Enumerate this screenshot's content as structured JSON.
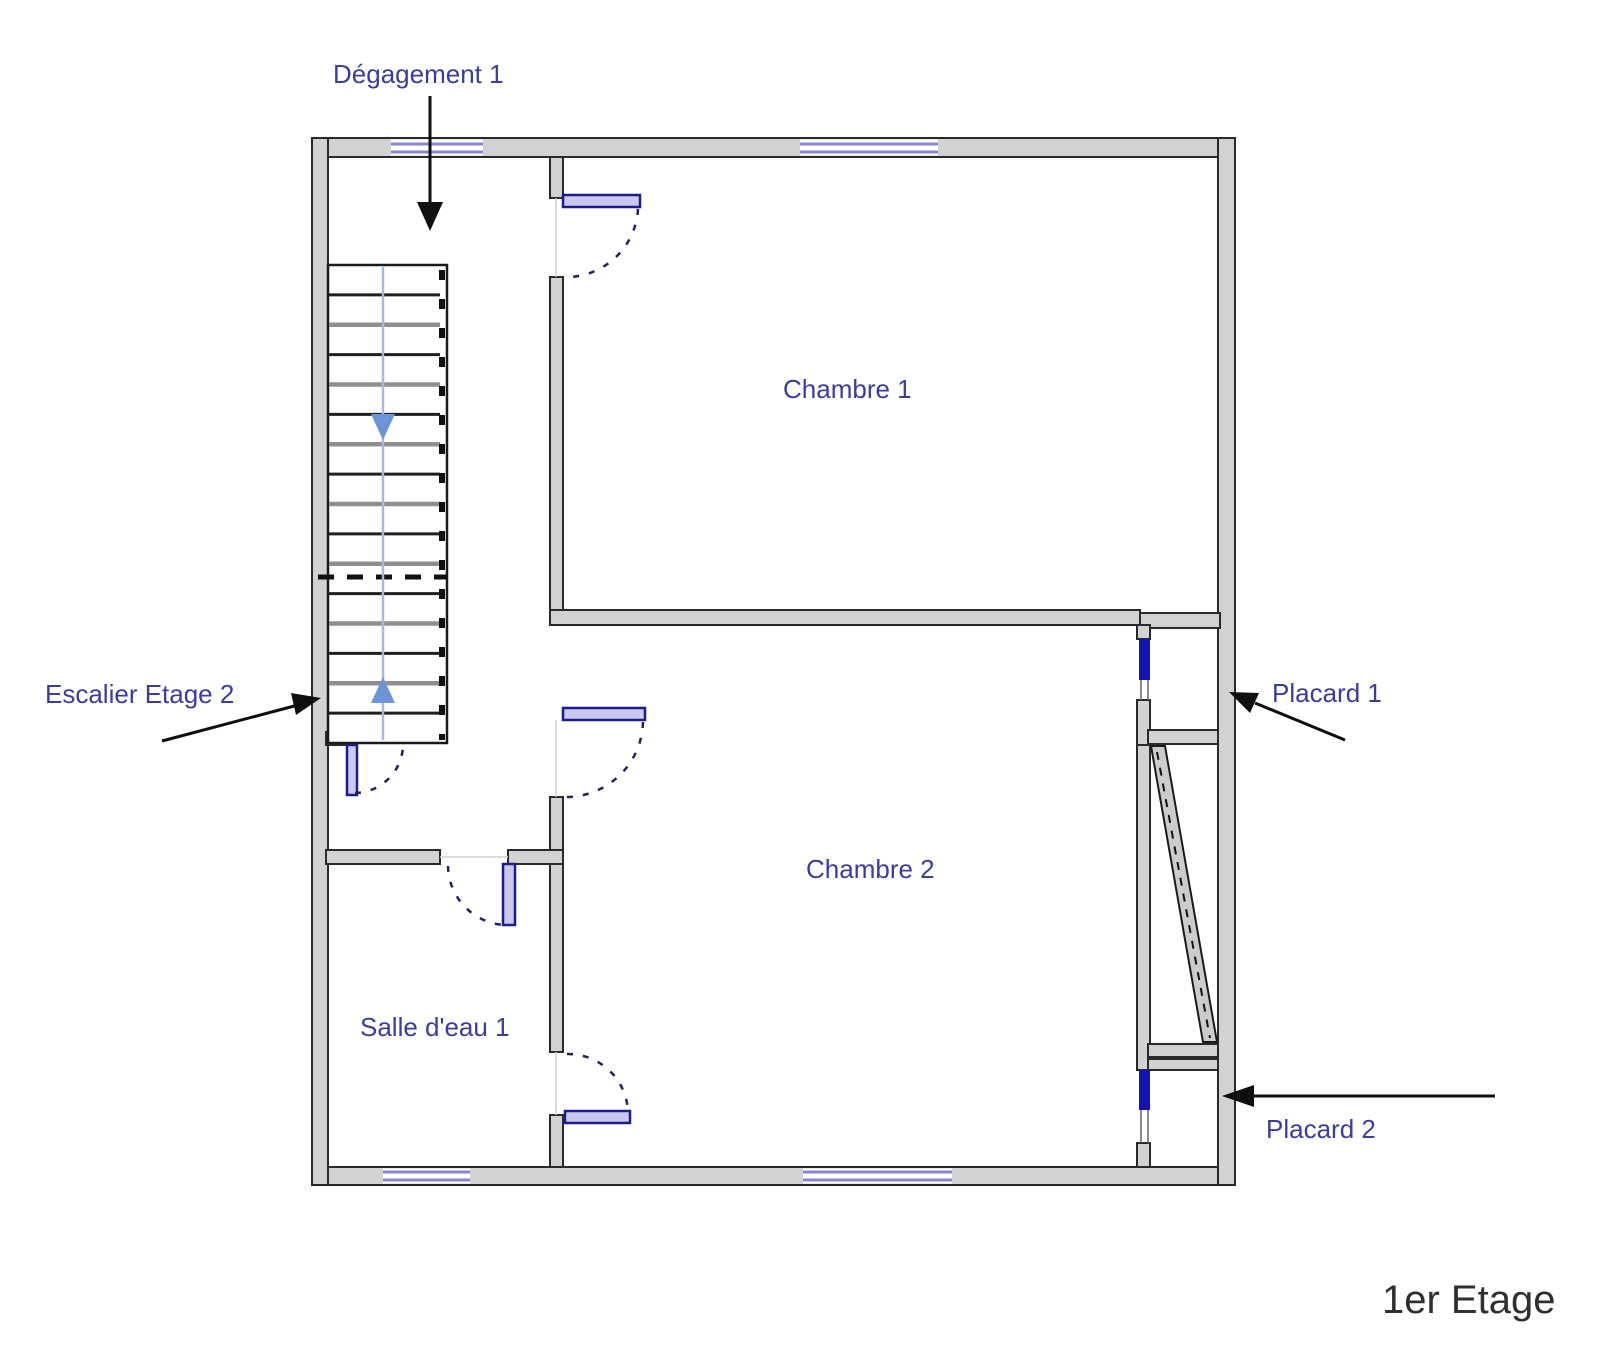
{
  "title": {
    "text": "1er Etage"
  },
  "labels": {
    "degagement": "Dégagement 1",
    "chambre1": "Chambre 1",
    "chambre2": "Chambre 2",
    "salle_eau": "Salle d'eau 1",
    "escalier": "Escalier Etage 2",
    "placard1": "Placard 1",
    "placard2": "Placard 2"
  },
  "stairs": {
    "tread_count": 15,
    "has_up_arrow": true,
    "has_down_arrow": true
  },
  "colors": {
    "wall-fill": "#d2d2d2",
    "wall-stroke": "#2a2a2a",
    "window-blue": "#8787d2",
    "door-stroke": "#1c1c8c",
    "door-fill": "#c9c9ef",
    "closet-blue": "#1313b5",
    "stair-arrow": "#6d94d5",
    "stair-line": "#a3badf",
    "label-color": "#3c3c9e",
    "annotation-color": "#0f0f0f",
    "title-color": "#2f2f2f",
    "tread-dark": "#1f1f1f",
    "tread-light": "#8f8f8f",
    "arc-color": "#232355"
  }
}
